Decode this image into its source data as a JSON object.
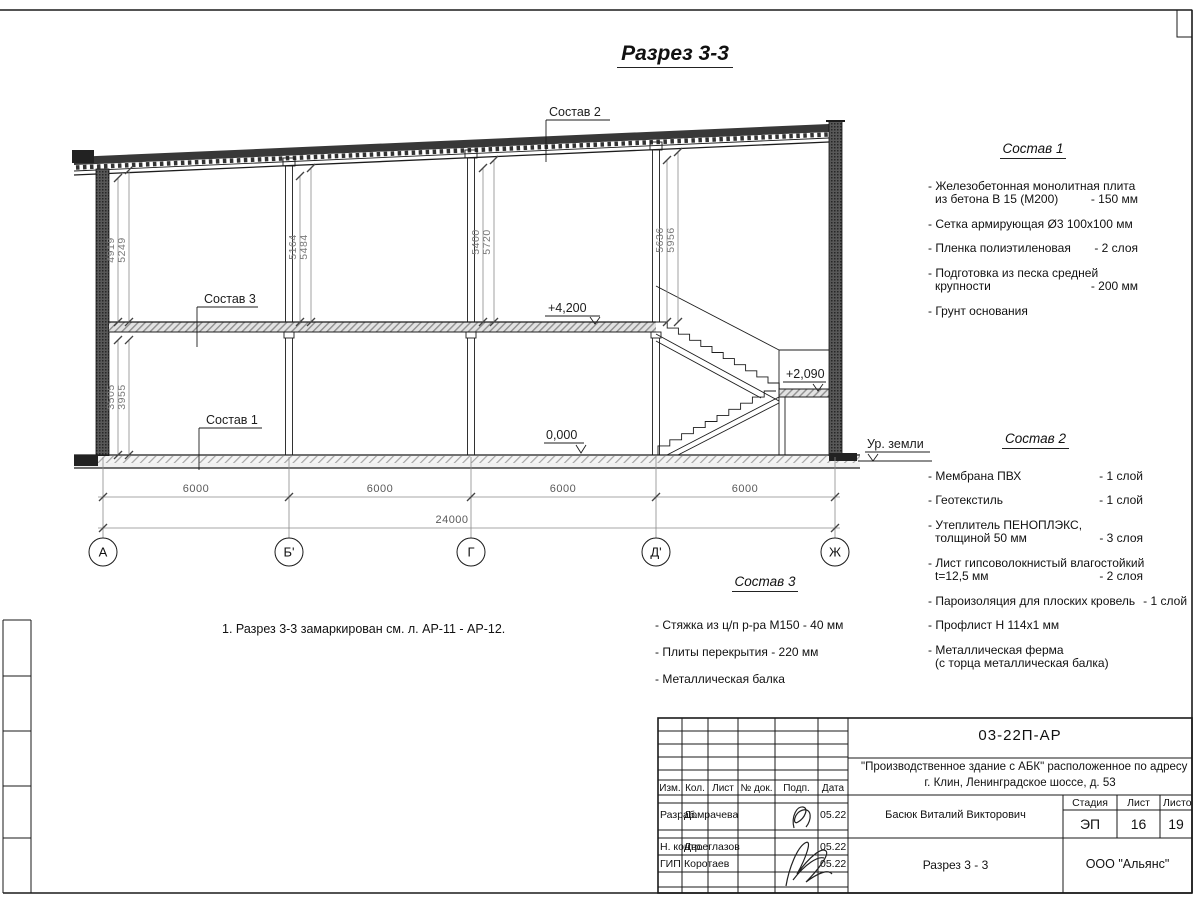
{
  "page": {
    "title": "Разрез 3-3",
    "note": "1. Разрез 3-3 замаркирован см. л. АР-11 - АР-12."
  },
  "drawing": {
    "callouts": {
      "c1": "Состав 1",
      "c2": "Состав 2",
      "c3": "Состав 3"
    },
    "elevations": {
      "second_floor": "+4,200",
      "zero": "0,000",
      "landing": "+2,090",
      "ground": "Ур. земли"
    },
    "vdims": {
      "a1": "4919",
      "a2": "5249",
      "a3": "3505",
      "a4": "3955",
      "b1": "5164",
      "b2": "5484",
      "g1": "5400",
      "g2": "5720",
      "d1": "5636",
      "d2": "5956"
    },
    "axes": [
      "А",
      "Б'",
      "Г",
      "Д'",
      "Ж"
    ],
    "spans": [
      "6000",
      "6000",
      "6000",
      "6000"
    ],
    "total": "24000"
  },
  "spec1": {
    "title": "Состав 1",
    "items": [
      {
        "l1": "- Железобетонная  монолитная плита",
        "l2": "из бетона В 15 (М200)",
        "v2": "- 150 мм"
      },
      {
        "l1": "- Сетка армирующая Ø3 100х100 мм"
      },
      {
        "l1": "- Пленка полиэтиленовая",
        "v1": "-  2 слоя"
      },
      {
        "l1": "- Подготовка из песка средней",
        "l2": "крупности",
        "v2": "- 200 мм"
      },
      {
        "l1": "- Грунт основания"
      }
    ]
  },
  "spec2": {
    "title": "Состав 2",
    "items": [
      {
        "l1": "- Мембрана ПВХ",
        "v1": "- 1 слой"
      },
      {
        "l1": "- Геотекстиль",
        "v1": "- 1 слой"
      },
      {
        "l1": "- Утеплитель ПЕНОПЛЭКС,",
        "l2": "толщиной 50 мм",
        "v2": "- 3 слоя"
      },
      {
        "l1": "- Лист гипсоволокнистый влагостойкий",
        "l2": "t=12,5 мм",
        "v2": "- 2 слоя"
      },
      {
        "l1": "- Пароизоляция для плоских кровель",
        "v1": "- 1 слой"
      },
      {
        "l1": "- Профлист Н 114х1 мм"
      },
      {
        "l1": "- Металлическая ферма",
        "l2": "(с торца металлическая балка)"
      }
    ]
  },
  "spec3": {
    "title": "Состав 3",
    "items": [
      {
        "l1": "- Стяжка из ц/п р-ра М150 - 40 мм"
      },
      {
        "l1": "- Плиты перекрытия - 220 мм"
      },
      {
        "l1": "- Металлическая балка"
      }
    ]
  },
  "titleblock": {
    "doc_code": "03-22П-АР",
    "project_line1": "\"Производственное здание с АБК\" расположенное по адресу",
    "project_line2": "г. Клин, Ленинградское шоссе, д. 53",
    "header_cols": [
      "Изм.",
      "Кол.",
      "Лист",
      "№ док.",
      "Подп.",
      "Дата"
    ],
    "rows": [
      {
        "role": "Разраб.",
        "name": "Домрачева",
        "date": "05.22"
      },
      {
        "role": "Н. контр.",
        "name": "Двоеглазов",
        "date": "05.22"
      },
      {
        "role": "ГИП",
        "name": "Коротаев",
        "date": "05.22"
      }
    ],
    "approver": "Басюк Виталий Викторович",
    "stage_label": "Стадия",
    "sheet_label": "Лист",
    "sheets_label": "Листов",
    "stage": "ЭП",
    "sheet": "16",
    "sheets": "19",
    "sheet_title": "Разрез 3 - 3",
    "company": "ООО \"Альянс\""
  }
}
